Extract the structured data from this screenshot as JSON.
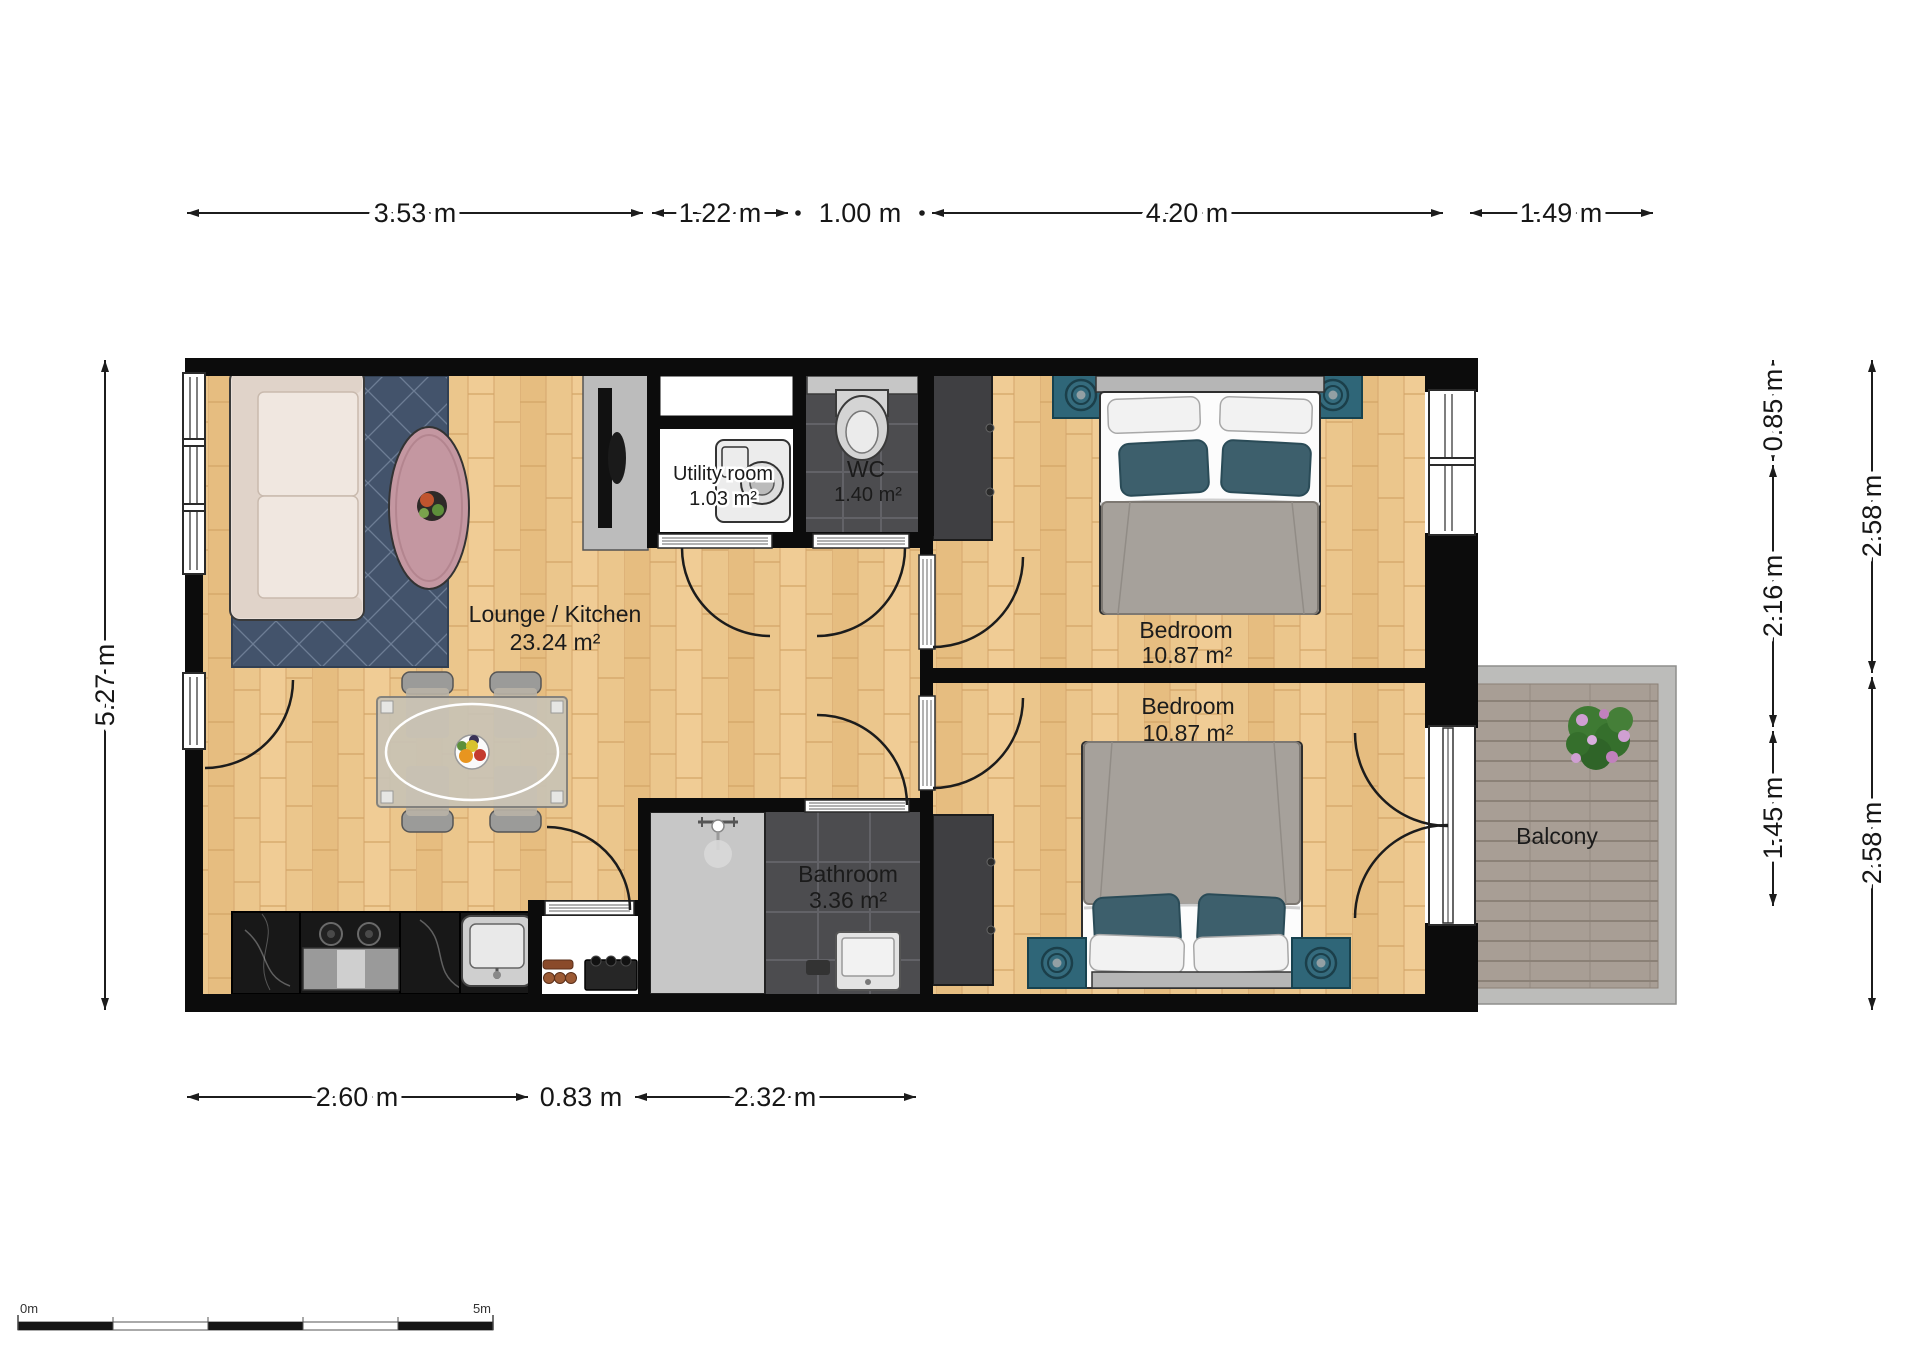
{
  "floorplan": {
    "rooms": {
      "lounge": {
        "name": "Lounge  / Kitchen",
        "area": "23.24 m²"
      },
      "utility": {
        "name": "Utility room",
        "area": "1.03 m²"
      },
      "wc": {
        "name": "WC",
        "area": "1.40 m²"
      },
      "bedroom_top": {
        "name": "Bedroom",
        "area": "10.87 m²"
      },
      "bedroom_bottom": {
        "name": "Bedroom",
        "area": "10.87 m²"
      },
      "bathroom": {
        "name": "Bathroom",
        "area": "3.36 m²"
      },
      "balcony": {
        "name": "Balcony"
      }
    },
    "dimensions": {
      "top": [
        "3.53 m",
        "1.22 m",
        "1.00 m",
        "4.20 m",
        "1.49 m"
      ],
      "bottom": [
        "2.60 m",
        "0.83 m",
        "2.32 m"
      ],
      "left": [
        "5.27 m"
      ],
      "right_inner": [
        "0.85 m",
        "2.16 m",
        "1.45 m"
      ],
      "right_outer": [
        "2.58 m",
        "2.58 m"
      ]
    },
    "scale_bar": {
      "start_label": "0m",
      "end_label": "5m"
    },
    "colors": {
      "wall": "#0c0c0c",
      "wood_floor": "#ebc68c",
      "dark_tile": "#4c4c4f",
      "teal_accent": "#2f6678",
      "rug": "#43536b",
      "coffee_table": "#c497a1",
      "balcony_deck": "#a89e95"
    }
  }
}
